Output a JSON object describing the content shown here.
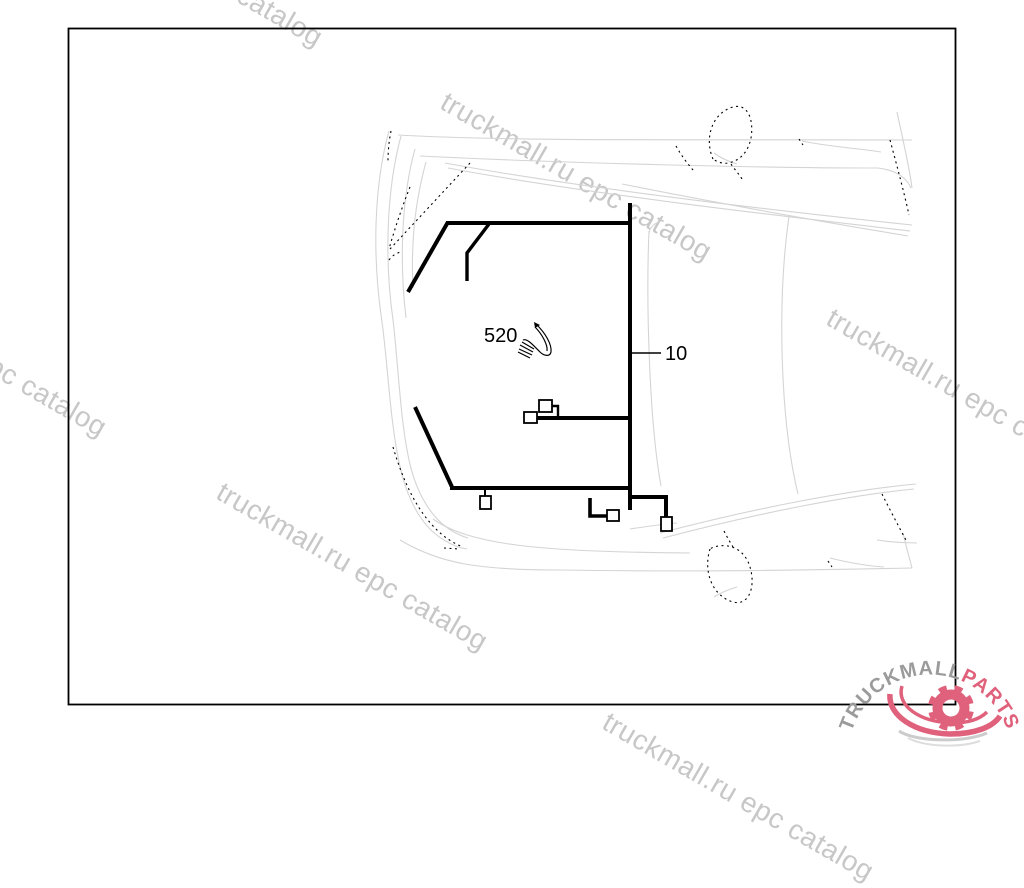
{
  "diagram": {
    "description": "Top view of vehicle front with wiring harness routing",
    "labels": [
      {
        "text": "520"
      },
      {
        "text": "10"
      }
    ]
  },
  "watermark": {
    "text": "truckmall.ru epc catalog"
  },
  "logo": {
    "brand": "TRUCKMALL",
    "suffix": "PARTS"
  },
  "icons": {
    "part_520": "wire-harness-clip-icon",
    "logo": "gear-swoosh-icon"
  },
  "colors": {
    "harness": "#000000",
    "car_outline": "#d4d4d4",
    "watermark": "#c7c7c7",
    "logo_gray": "#9b9b9b",
    "logo_pink": "#e0617b"
  }
}
